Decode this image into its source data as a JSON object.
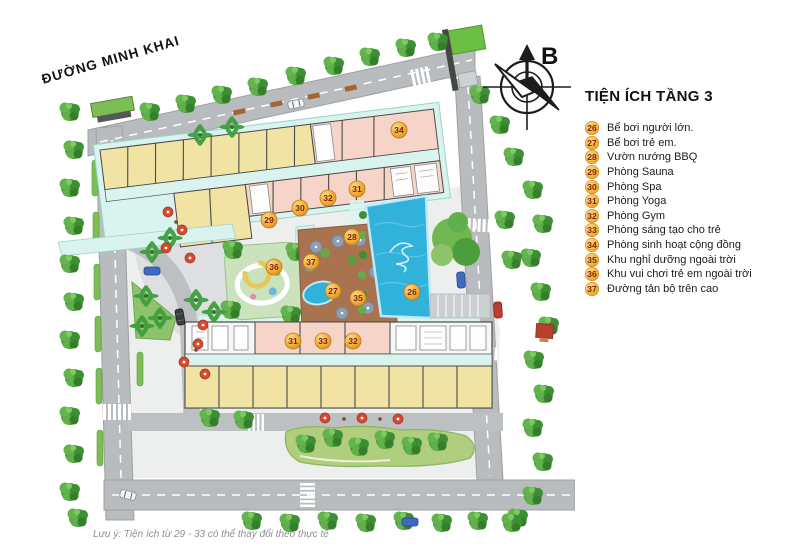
{
  "street_label": "ĐƯỜNG MINH KHAI",
  "compass": {
    "label": "B"
  },
  "legend": {
    "title": "TIỆN ÍCH TẦNG 3",
    "items": [
      {
        "num": "26",
        "label": "Bể bơi người lớn."
      },
      {
        "num": "27",
        "label": "Bể bơi trẻ em."
      },
      {
        "num": "28",
        "label": "Vườn nướng BBQ"
      },
      {
        "num": "29",
        "label": "Phòng Sauna"
      },
      {
        "num": "30",
        "label": "Phòng Spa"
      },
      {
        "num": "31",
        "label": "Phòng Yoga"
      },
      {
        "num": "32",
        "label": "Phòng Gym"
      },
      {
        "num": "33",
        "label": "Phòng sáng tạo cho trẻ"
      },
      {
        "num": "34",
        "label": "Phòng sinh hoạt cộng đồng"
      },
      {
        "num": "35",
        "label": "Khu nghỉ dưỡng ngoài trời"
      },
      {
        "num": "36",
        "label": "Khu vui chơi trẻ em ngoài trời"
      },
      {
        "num": "37",
        "label": "Đường tản bộ trên cao"
      }
    ]
  },
  "plan_markers": [
    {
      "num": "34",
      "x": 399,
      "y": 130
    },
    {
      "num": "31",
      "x": 357,
      "y": 189
    },
    {
      "num": "32",
      "x": 328,
      "y": 198
    },
    {
      "num": "30",
      "x": 300,
      "y": 208
    },
    {
      "num": "29",
      "x": 269,
      "y": 220
    },
    {
      "num": "28",
      "x": 352,
      "y": 237
    },
    {
      "num": "37",
      "x": 311,
      "y": 262
    },
    {
      "num": "36",
      "x": 274,
      "y": 267
    },
    {
      "num": "27",
      "x": 333,
      "y": 291
    },
    {
      "num": "35",
      "x": 358,
      "y": 298
    },
    {
      "num": "26",
      "x": 412,
      "y": 292
    },
    {
      "num": "31",
      "x": 293,
      "y": 341
    },
    {
      "num": "33",
      "x": 323,
      "y": 341
    },
    {
      "num": "32",
      "x": 353,
      "y": 341
    }
  ],
  "footnote": "Lưu ý: Tiện ích từ 29 - 33 có thể thay đổi theo thực tế",
  "colors": {
    "badge": "#F3B13C",
    "badge_text": "#7E2412",
    "pool": "#30B2DB",
    "room_yellow": "#F0E3A4",
    "room_pink": "#F7D4C8",
    "corridor": "#D9F4EF",
    "road": "#B9BCBE",
    "tree": "#4C9E3C",
    "terrace": "#A9734F"
  }
}
